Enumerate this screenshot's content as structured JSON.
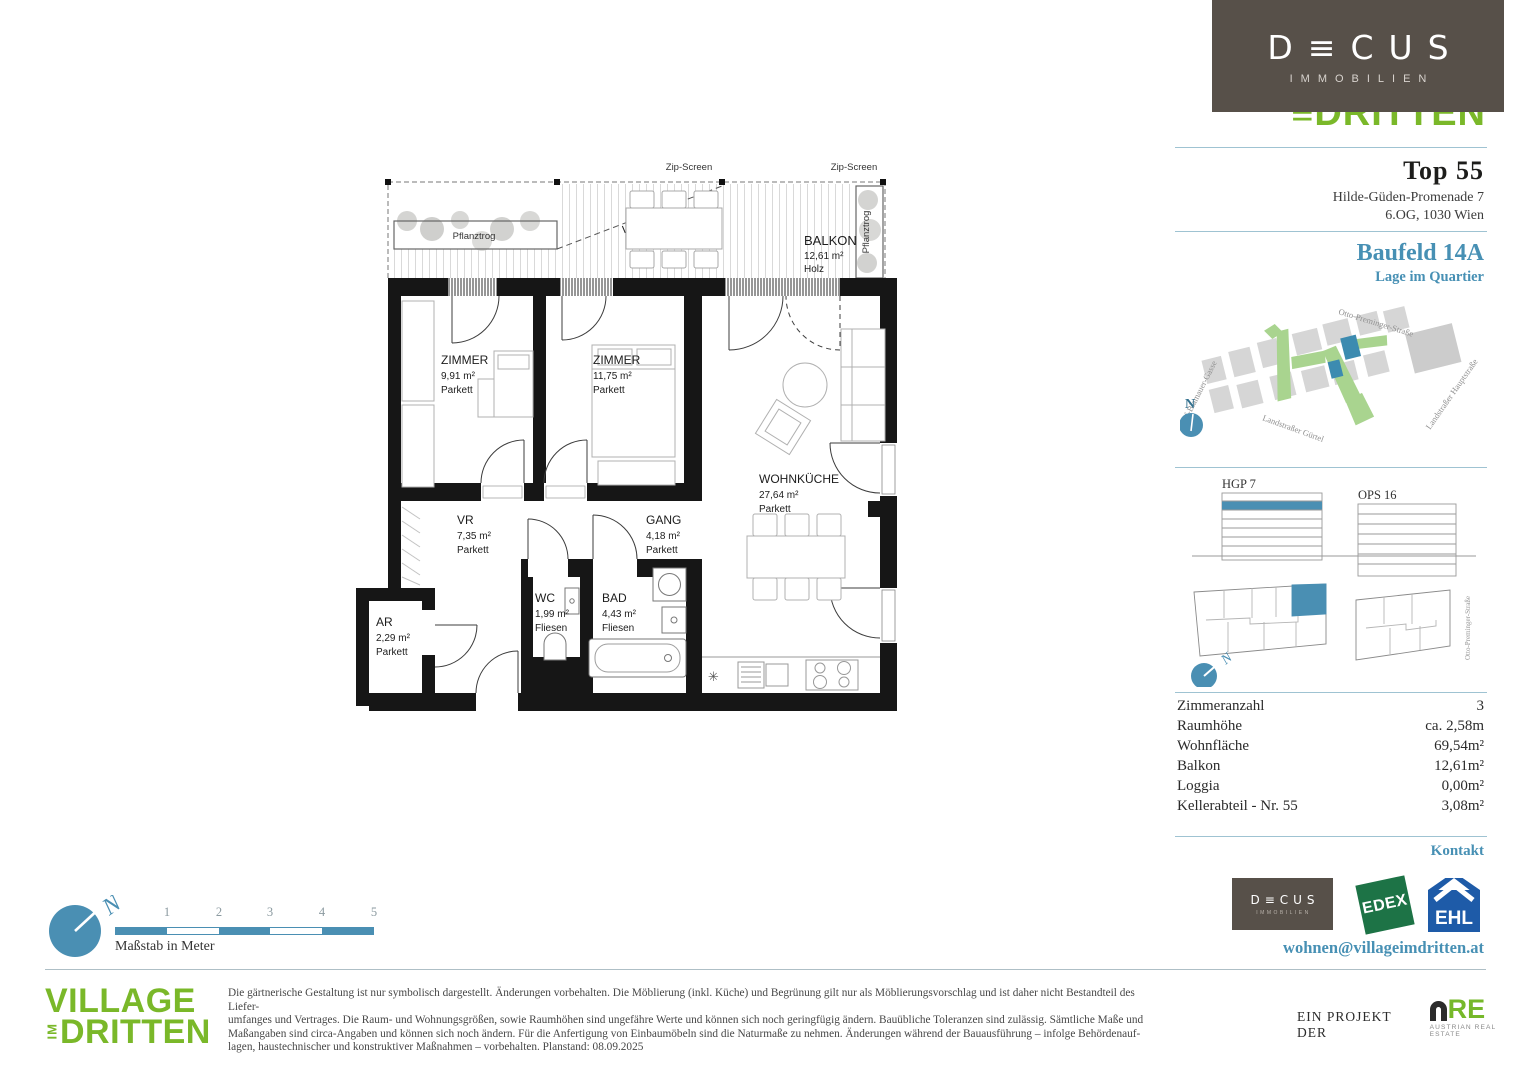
{
  "header": {
    "decus_logo": {
      "name": "D≡CUS",
      "subtitle": "IMMOBILIEN"
    },
    "partial_logo": "≡DRITTEN"
  },
  "unit": {
    "title": "Top 55",
    "address_line1": "Hilde-Güden-Promenade 7",
    "address_line2": "6.OG, 1030 Wien",
    "baufeld": "Baufeld 14A",
    "location_caption": "Lage im Quartier"
  },
  "map": {
    "street_top": "Otto-Preminger-Straße",
    "street_left": "Adolf-Blamauer-Gasse",
    "street_bottom": "Landstraßer Gürtel",
    "street_right": "Landstraßer Hauptstraße",
    "compass": "N"
  },
  "buildings": {
    "left_label": "HGP 7",
    "right_label": "OPS 16",
    "street_label": "Otto-Preminger-Straße",
    "compass": "N"
  },
  "details": {
    "rows": [
      {
        "label": "Zimmeranzahl",
        "value": "3"
      },
      {
        "label": "Raumhöhe",
        "value": "ca. 2,58m"
      },
      {
        "label": "Wohnfläche",
        "value": "69,54m²"
      },
      {
        "label": "Balkon",
        "value": "12,61m²"
      },
      {
        "label": "Loggia",
        "value": "0,00m²"
      },
      {
        "label": "Kellerabteil - Nr. 55",
        "value": "3,08m²"
      }
    ]
  },
  "contact": {
    "heading": "Kontakt",
    "email": "wohnen@villageimdritten.at",
    "decus": {
      "name": "D≡CUS",
      "subtitle": "IMMOBILIEN"
    },
    "edex": "EDEX",
    "ehl": "EHL"
  },
  "plan": {
    "zip_screen_1": "Zip-Screen",
    "zip_screen_2": "Zip-Screen",
    "luftraum": "Luftraum",
    "pflanztrog_left": "Pflanztrog",
    "pflanztrog_right": "Pflanztrog",
    "light_symbol": "✳",
    "balkon": {
      "name": "BALKON",
      "area": "12,61 m²",
      "floor": "Holz"
    },
    "zimmer1": {
      "name": "ZIMMER",
      "area": "9,91 m²",
      "floor": "Parkett"
    },
    "zimmer2": {
      "name": "ZIMMER",
      "area": "11,75 m²",
      "floor": "Parkett"
    },
    "wohnkueche": {
      "name": "WOHNKÜCHE",
      "area": "27,64 m²",
      "floor": "Parkett"
    },
    "vr": {
      "name": "VR",
      "area": "7,35 m²",
      "floor": "Parkett"
    },
    "gang": {
      "name": "GANG",
      "area": "4,18 m²",
      "floor": "Parkett"
    },
    "wc": {
      "name": "WC",
      "area": "1,99 m²",
      "floor": "Fliesen"
    },
    "bad": {
      "name": "BAD",
      "area": "4,43 m²",
      "floor": "Fliesen"
    },
    "ar": {
      "name": "AR",
      "area": "2,29 m²",
      "floor": "Parkett"
    }
  },
  "scalebar": {
    "ticks": [
      "1",
      "2",
      "3",
      "4",
      "5"
    ],
    "caption": "Maßstab in Meter",
    "compass": "N"
  },
  "footer": {
    "village_logo": {
      "line1": "VILLAGE",
      "im": "IM",
      "line2": "DRITTEN"
    },
    "disclaimer": [
      "Die gärtnerische Gestaltung ist nur symbolisch dargestellt. Änderungen vorbehalten. Die Möblierung (inkl. Küche) und Begrünung gilt nur als Möblierungsvorschlag und ist daher nicht Bestandteil des Liefer-",
      "umfanges und Vertrages. Die Raum- und Wohnungsgrößen, sowie Raumhöhen sind ungefähre Werte und können sich noch geringfügig ändern. Bauübliche Toleranzen sind zulässig. Sämtliche Maße und",
      "Maßangaben sind circa-Angaben und können sich noch ändern. Für die Anfertigung von Einbaumöbeln sind die Naturmaße zu nehmen. Änderungen während der Bauausführung – infolge Behördenauf-",
      "lagen, haustechnischer und konstruktiver Maßnahmen – vorbehalten. Planstand: 08.09.2025"
    ],
    "project_prefix": "EIN PROJEKT DER",
    "are": {
      "name": "RE",
      "subtitle": "AUSTRIAN REAL ESTATE"
    }
  },
  "colors": {
    "accent_blue": "#4790b4",
    "village_green": "#7ab829",
    "edex_green": "#1d7346",
    "ehl_blue": "#1e5ba8",
    "are_green": "#76b82a",
    "decus_brown": "#575049",
    "map_green": "#a9d48f",
    "map_gray": "#d6d6d6"
  }
}
